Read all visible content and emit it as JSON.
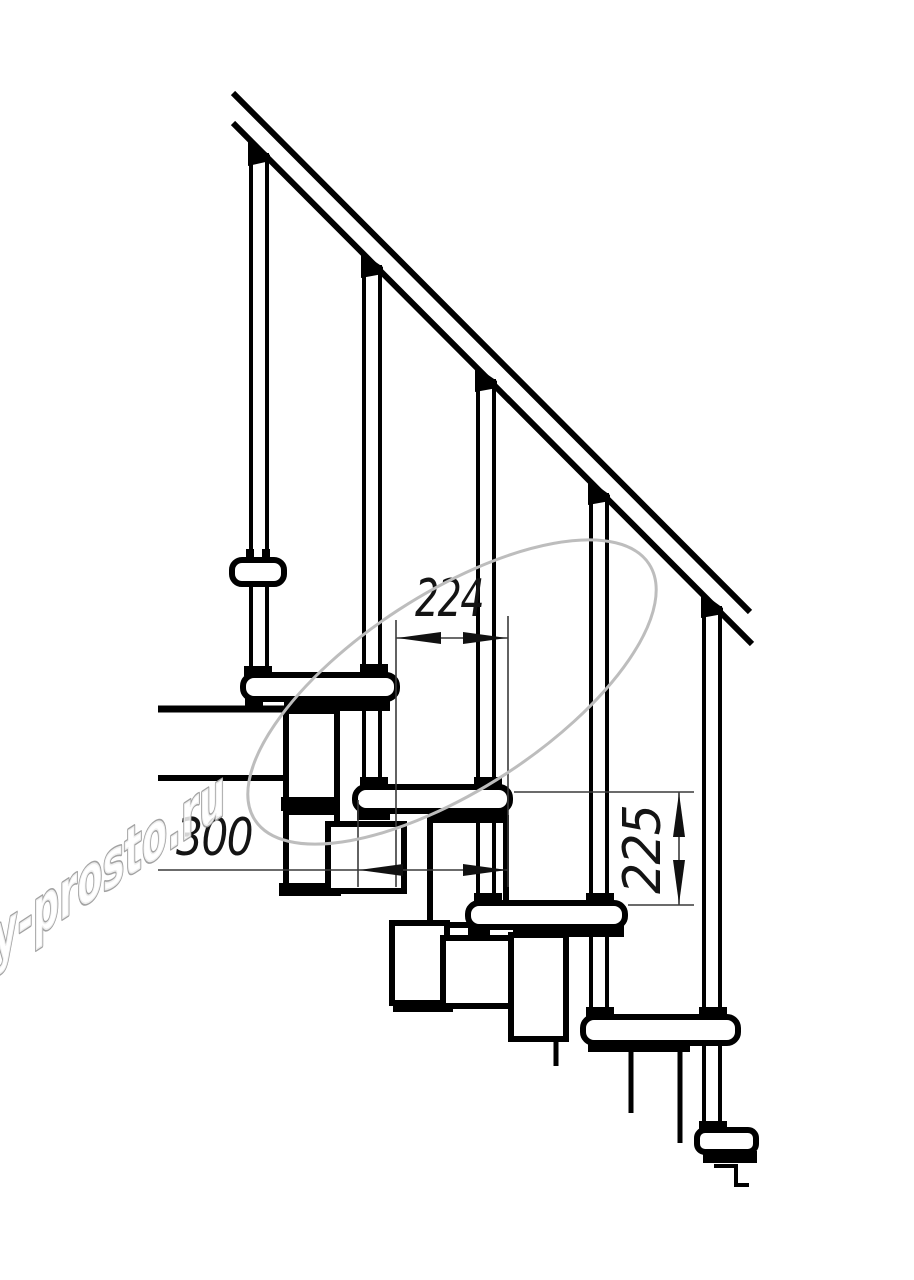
{
  "drawing": {
    "title": "Modular staircase side-view technical drawing",
    "background_color": "#ffffff",
    "line_color": "#000000",
    "dimensions": {
      "step_run": "224",
      "tread_depth": "300",
      "riser_height": "225"
    },
    "watermark": {
      "text": "lestnicy-prosto.ru",
      "color": "#a2a2a2"
    },
    "structure": {
      "balusters_count": 5,
      "treads_count": 5,
      "has_handrail": true
    }
  }
}
